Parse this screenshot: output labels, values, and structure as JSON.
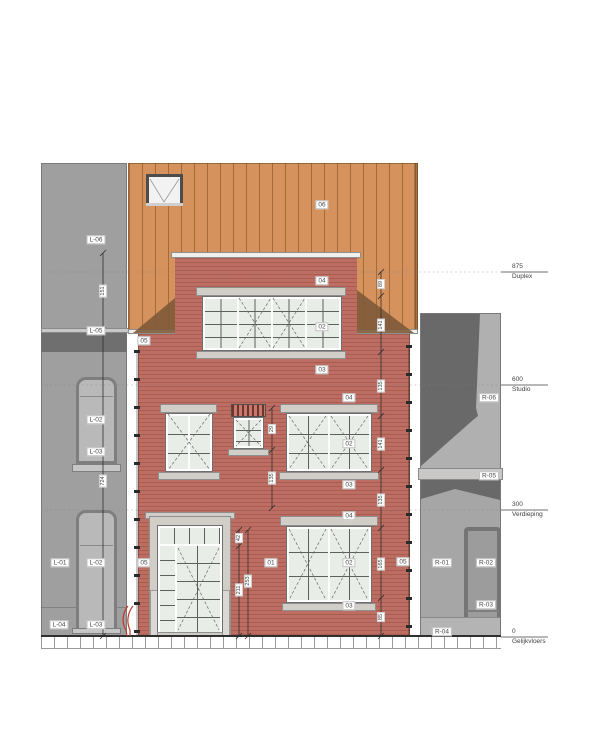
{
  "drawing": {
    "kind": "front elevation",
    "levels": [
      {
        "value": "875",
        "label": "Duplex"
      },
      {
        "value": "600",
        "label": "Studio"
      },
      {
        "value": "300",
        "label": "Verdieping"
      },
      {
        "value": "0",
        "label": "Gelijkvloers"
      }
    ]
  },
  "tags": {
    "n06": "06",
    "n05a": "05",
    "n05b": "05",
    "n05c": "05",
    "n04a": "04",
    "n02a": "02",
    "n03a": "03",
    "n04b": "04",
    "n02b": "02",
    "n03b": "03",
    "n04c": "04",
    "n02c": "02",
    "n03c": "03",
    "n01": "01",
    "l06": "L-06",
    "l05": "L-05",
    "l02a": "L-02",
    "l03a": "L-03",
    "l01": "L-01",
    "l02b": "L-02",
    "l04": "L-04",
    "l03b": "L-03",
    "r06": "R-06",
    "r05": "R-05",
    "r01": "R-01",
    "r02": "R-02",
    "r03": "R-03",
    "r04": "R-04"
  },
  "dimensions": {
    "left_top": "151",
    "left_total": "724",
    "right": [
      "89",
      "141",
      "135",
      "141",
      "135",
      "165",
      "85"
    ],
    "middle": [
      "29",
      "135"
    ],
    "door_transom": "42",
    "door_leaf": "211",
    "door_total": "253"
  },
  "colors": {
    "brick": "#bd6d62",
    "roof_wood": "#d5925c",
    "neighbor_wall": "#9f9f9f",
    "neighbor_shadow": "#6f6f6f",
    "stone_trim": "#d1cec8",
    "glass": "#e8ede8",
    "accent_red": "#c0392b"
  }
}
